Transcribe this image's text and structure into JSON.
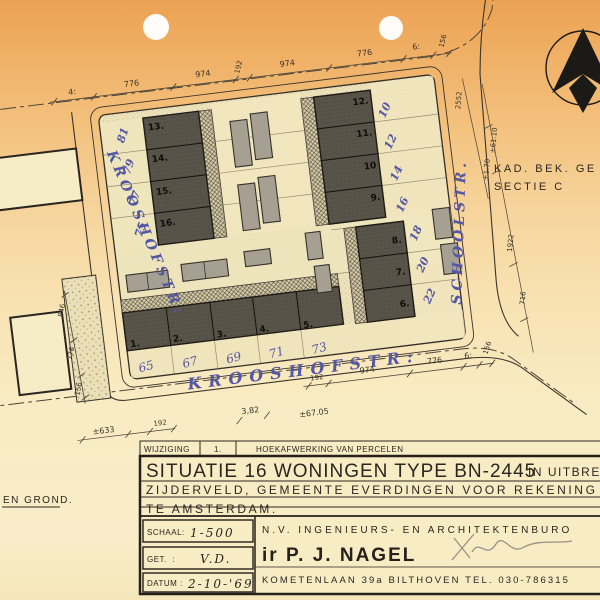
{
  "icons": {
    "north_arrow": "north-arrow-compass"
  },
  "kad_note": {
    "line1": "KAD. BEK. GE",
    "line2": "SECTIE C"
  },
  "streets": {
    "left": "KROOSHOFSTR:",
    "right": "SCHOOLSTR.",
    "bottom": "KROOSHOFSTR:"
  },
  "ground_note": "EN GROND.",
  "plots": {
    "upper_left": {
      "numbers": [
        "13.",
        "14.",
        "15.",
        "16."
      ],
      "house_numbers": [
        "81",
        "79",
        "77",
        "75"
      ]
    },
    "upper_right": {
      "numbers": [
        "12.",
        "11.",
        "10",
        "9."
      ],
      "house_numbers": [
        "10",
        "12",
        "14",
        "16"
      ]
    },
    "lower_left": {
      "numbers": [
        "1.",
        "2.",
        "3.",
        "4.",
        "5."
      ],
      "house_numbers": [
        "65",
        "67",
        "69",
        "71",
        "73"
      ]
    },
    "lower_right": {
      "numbers": [
        "8.",
        "7.",
        "6."
      ],
      "house_numbers": [
        "18",
        "20",
        "22"
      ]
    }
  },
  "dims": {
    "top": [
      "4:",
      "776",
      "974",
      "192",
      "974",
      "776",
      "6:",
      "156"
    ],
    "bottom": [
      "192",
      "974",
      "776",
      "6:",
      "156"
    ],
    "left": [
      "846",
      "776",
      "156"
    ],
    "right": [
      "2552",
      "±61.10",
      "±1.70",
      "1922",
      "716"
    ],
    "misc": [
      "±633",
      "192",
      "3,82",
      "±67.05"
    ]
  },
  "title_block": {
    "revision": {
      "label": "WIJZIGING",
      "number": "1.",
      "note": "HOEKAFWERKING VAN PERCELEN"
    },
    "title_line1": "SITUATIE 16 WONINGEN TYPE BN-2445",
    "title_line1b": "IN UITBREIDI",
    "title_line2": "ZIJDERVELD, GEMEENTE EVERDINGEN VOOR REKENING VA",
    "title_line3": "TE AMSTERDAM.",
    "scale_label": "SCHAAL:",
    "scale_value": "1-500",
    "drawn_label": "GET.  :",
    "drawn_value": "V.D.",
    "date_label": "DATUM :",
    "date_value": "2-10-'69",
    "firm": "N.V. INGENIEURS- EN ARCHITEKTENBURO",
    "architect": "ir P. J. NAGEL",
    "address": "KOMETENLAAN 39a BILTHOVEN TEL. 030-786315"
  },
  "colors": {
    "paper_top": "#efae63",
    "paper_bottom": "#f9ecc4",
    "ink": "#35302a",
    "blue_ink": "#5457a4",
    "building": "#585349"
  }
}
